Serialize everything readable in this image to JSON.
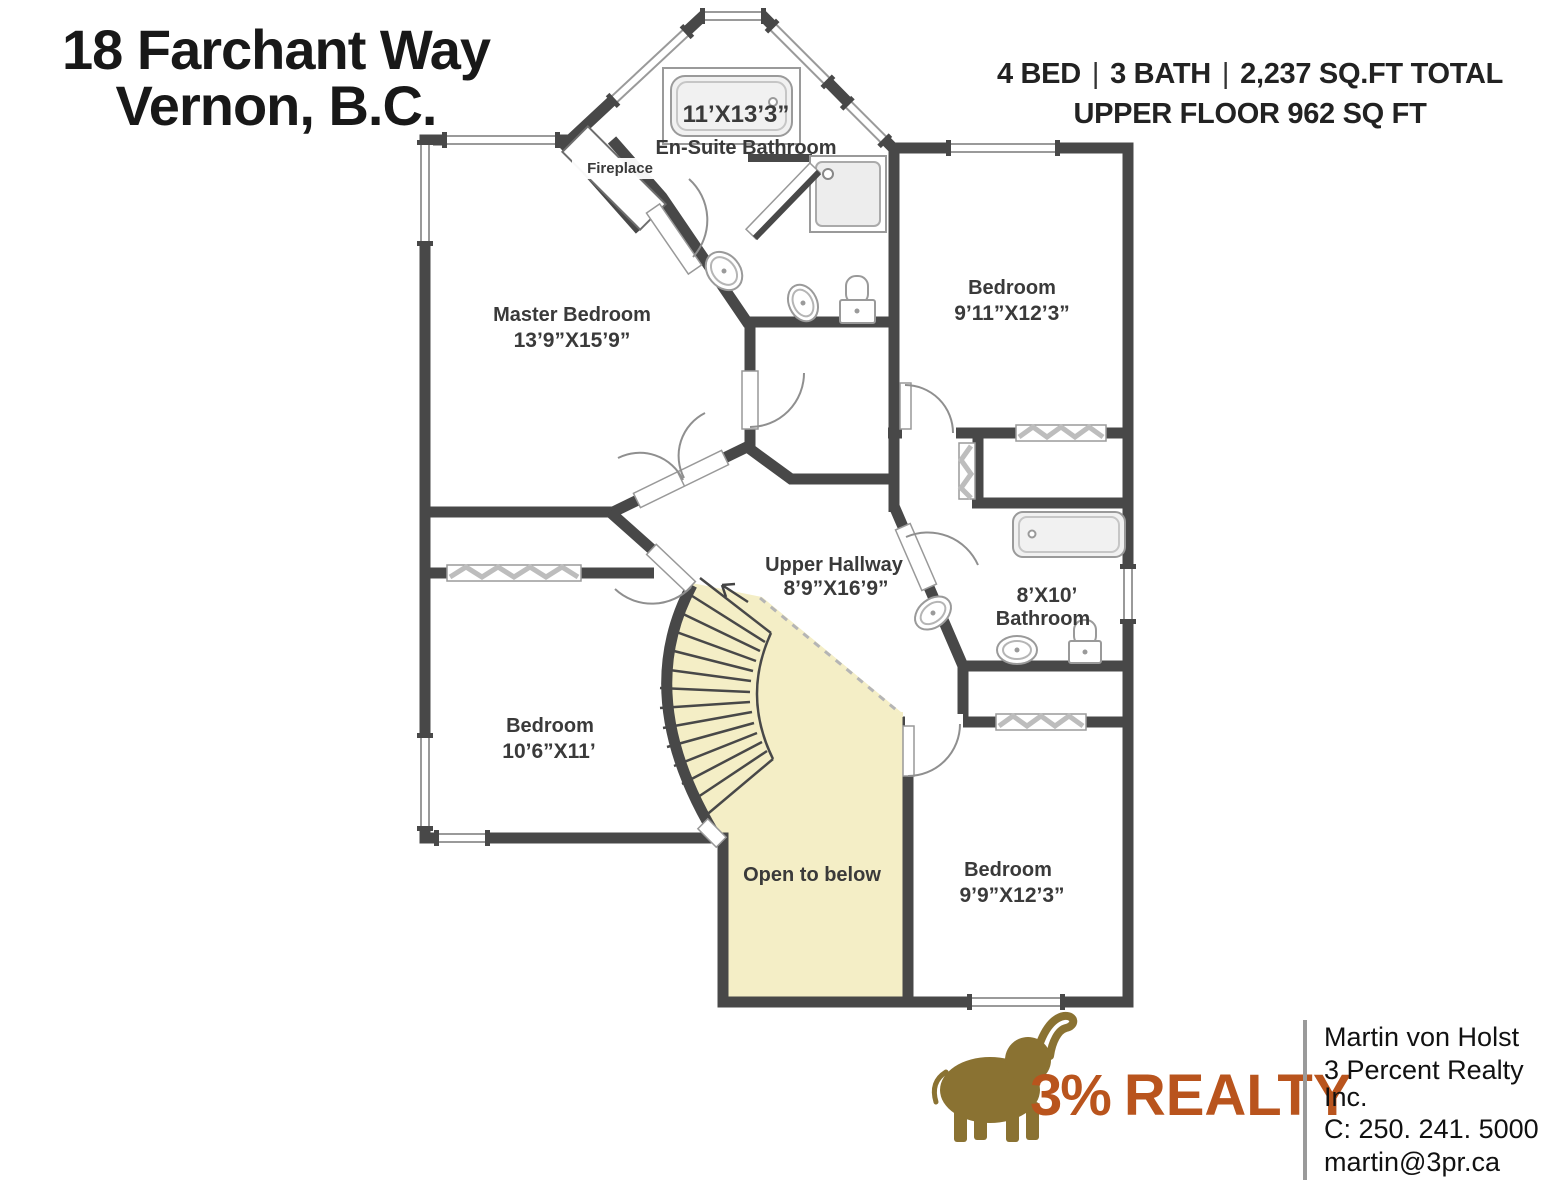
{
  "header": {
    "address_line1": "18 Farchant Way",
    "address_line2": "Vernon, B.C.",
    "beds": "4 BED",
    "baths": "3 BATH",
    "area": "2,237 SQ.FT TOTAL",
    "floor_area": "UPPER FLOOR 962 SQ FT",
    "separator": "|"
  },
  "floorplan": {
    "rooms": [
      {
        "name": "Master Bedroom",
        "dims": "13’9”X15’9”"
      },
      {
        "name": "En-Suite Bathroom",
        "dims": "11’X13’3”"
      },
      {
        "name": "Bedroom",
        "dims": "9’11”X12’3”"
      },
      {
        "name": "Upper Hallway",
        "dims": "8’9”X16’9”"
      },
      {
        "name": "Bathroom",
        "dims": "8’X10’"
      },
      {
        "name": "Bedroom",
        "dims": "10’6”X11’"
      },
      {
        "name": "Bedroom",
        "dims": "9’9”X12’3”"
      }
    ],
    "labels": {
      "fireplace": "Fireplace",
      "open_to_below": "Open to below"
    }
  },
  "footer": {
    "brand_pct": "3%",
    "brand_name": "REALTY",
    "agent_name": "Martin von Holst",
    "brokerage": "3 Percent Realty Inc.",
    "phone": "C: 250. 241. 5000",
    "email": "martin@3pr.ca"
  },
  "colors": {
    "wall": "#484848",
    "stairs_fill": "#f4eec6",
    "brand_orange": "#b9541d",
    "brand_gold": "#8a7232"
  }
}
